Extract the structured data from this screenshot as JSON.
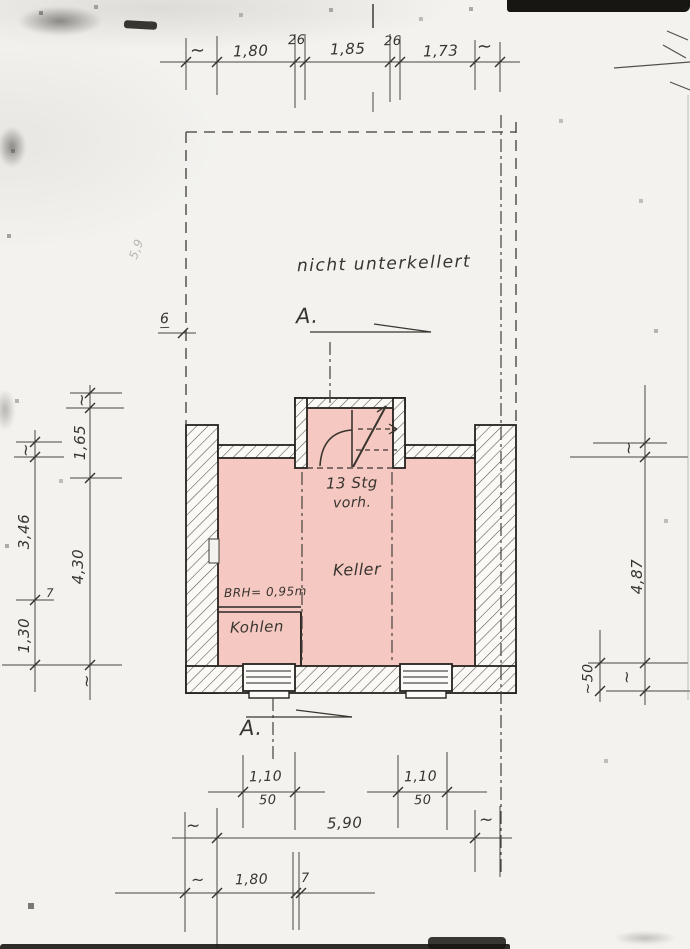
{
  "colors": {
    "room_fill": "#f5c9c2",
    "line": "#3f3b36",
    "wall_edge": "#26221e",
    "paper": "#f3f2ef"
  },
  "plan": {
    "area_note": "nicht unterkellert",
    "room_keller": "Keller",
    "room_kohlen": "Kohlen",
    "stair_note_1": "13 Stg",
    "stair_note_2": "vorh.",
    "sill_note": "BRH= 0,95m",
    "section_label": "A.",
    "offset_label": "6",
    "faint_note": "5,9"
  },
  "dims": {
    "tilde": "~",
    "top": {
      "a": "1,80",
      "wall1": "26",
      "b": "1,85",
      "wall2": "26",
      "c": "1,73"
    },
    "left_outer": {
      "a": "3,46",
      "b": "7",
      "c": "1,30"
    },
    "left_inner": {
      "a": "1,65",
      "b": "4,30"
    },
    "right": {
      "a": "4,87",
      "b": "~50"
    },
    "windows": {
      "w": "1,10",
      "h": "50"
    },
    "total_width": "5,90",
    "bottom": {
      "a": "1,80",
      "b": "7"
    }
  }
}
